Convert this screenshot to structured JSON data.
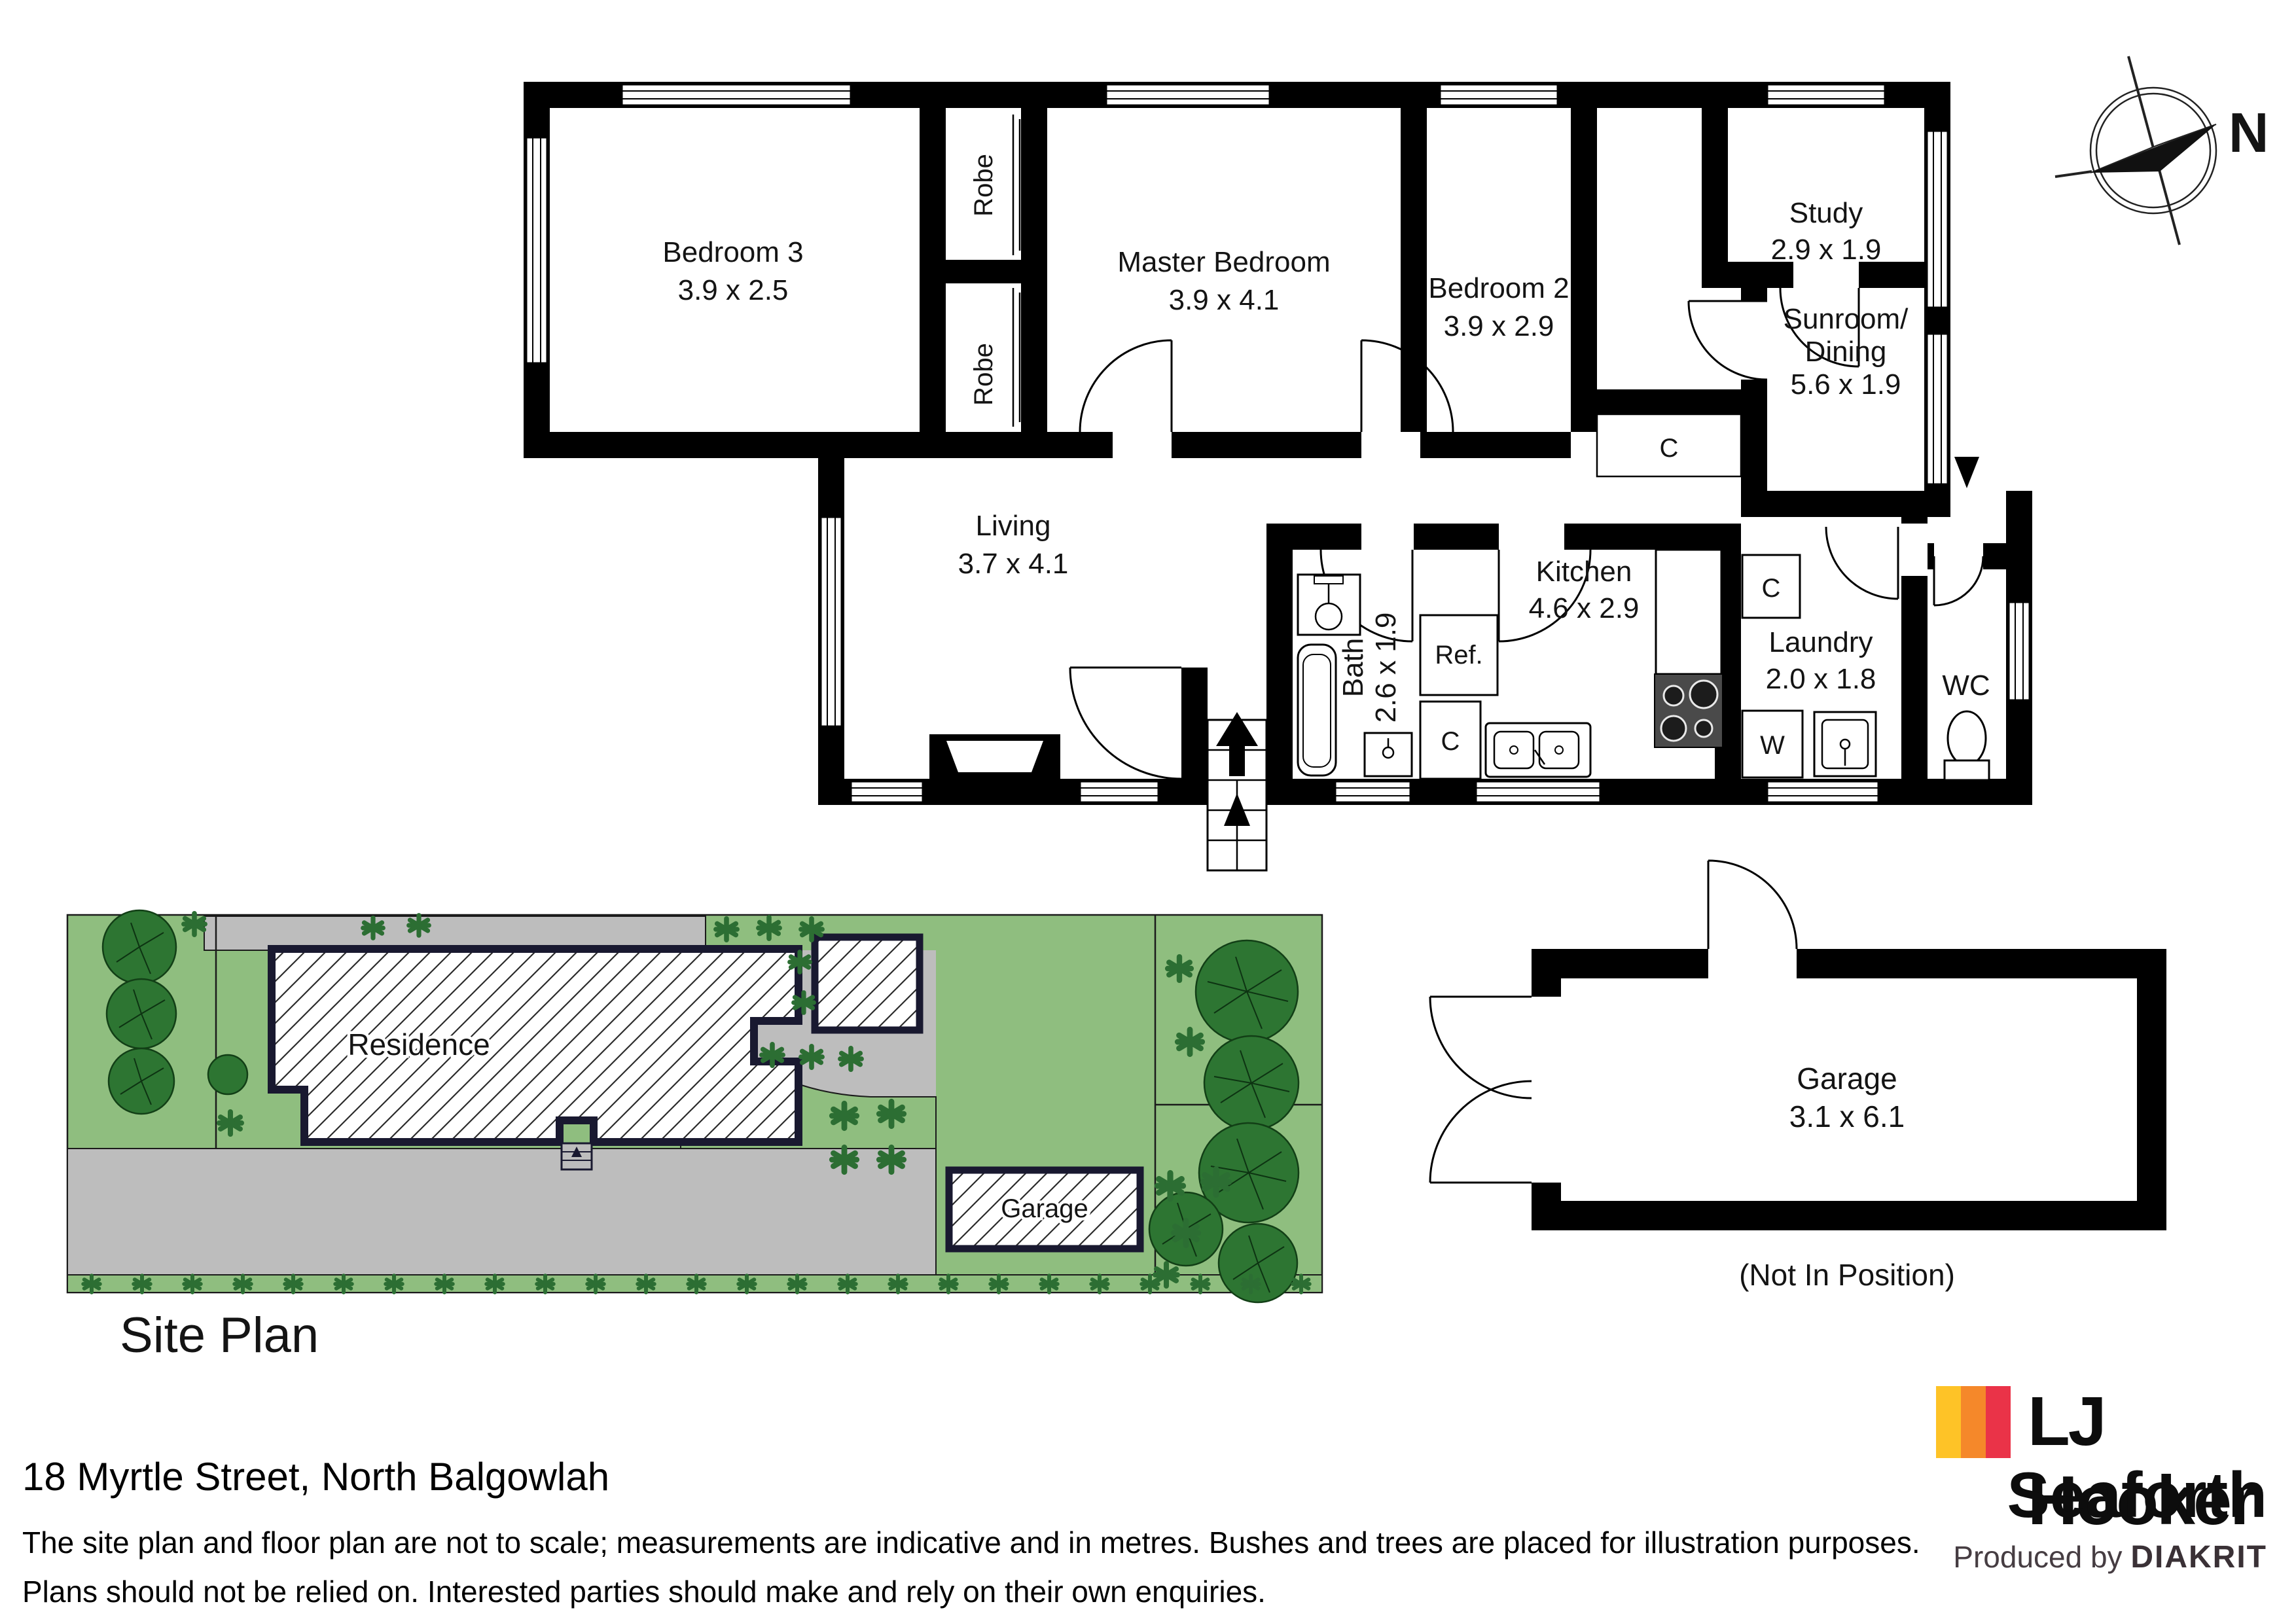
{
  "floor_plan": {
    "rooms": {
      "bedroom3": {
        "name": "Bedroom 3",
        "dims": "3.9 x 2.5"
      },
      "master_bedroom": {
        "name": "Master Bedroom",
        "dims": "3.9 x 4.1"
      },
      "bedroom2": {
        "name": "Bedroom 2",
        "dims": "3.9 x 2.9"
      },
      "study": {
        "name": "Study",
        "dims": "2.9 x 1.9"
      },
      "sunroom_dining": {
        "name_line1": "Sunroom/",
        "name_line2": "Dining",
        "dims": "5.6 x 1.9"
      },
      "living": {
        "name": "Living",
        "dims": "3.7 x 4.1"
      },
      "bath": {
        "name": "Bath",
        "dims": "2.6 x 1.9"
      },
      "kitchen": {
        "name": "Kitchen",
        "dims": "4.6 x 2.9"
      },
      "laundry": {
        "name": "Laundry",
        "dims": "2.0 x 1.8"
      },
      "wc": {
        "name": "WC"
      }
    },
    "fixtures": {
      "robe_top": "Robe",
      "robe_bottom": "Robe",
      "refrigerator": "Ref.",
      "cupboard_hall": "C",
      "cupboard_kitchen": "C",
      "cupboard_laundry": "C",
      "washer": "W"
    },
    "compass_label": "N"
  },
  "site_plan": {
    "title": "Site Plan",
    "residence_label": "Residence",
    "garage_label": "Garage"
  },
  "garage_plan": {
    "name": "Garage",
    "dims": "3.1 x 6.1",
    "note": "(Not In Position)"
  },
  "footer": {
    "address": "18 Myrtle Street, North Balgowlah",
    "disclaimer_line1": "The site plan and floor plan are not to scale; measurements are indicative and in metres. Bushes and trees are placed for illustration purposes.",
    "disclaimer_line2": "Plans should not be relied on. Interested parties should make and rely on their own enquiries."
  },
  "branding": {
    "brand": "LJ Hooker",
    "office": "Seaforth",
    "produced_by": "Produced by",
    "producer": "DIAKRIT"
  },
  "palette": {
    "lawn": "#8FBE7F",
    "driveway": "#BDBDBD",
    "tree_fill": "#2D7532",
    "bush": "#2C6E33",
    "plan_outline": "#191930",
    "logo_yellow": "#FEC327",
    "logo_orange": "#F5882A",
    "logo_red": "#EA3348"
  }
}
